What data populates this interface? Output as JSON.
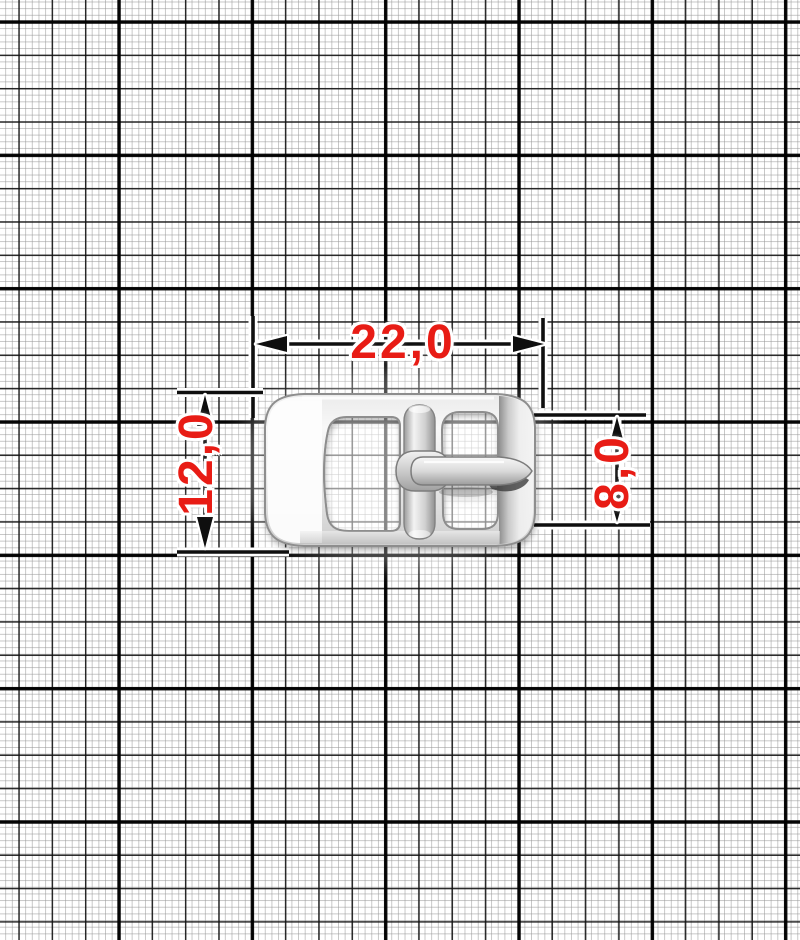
{
  "drawing": {
    "subject": "metal pin buckle on millimeter graph paper",
    "labels": {
      "width": "22,0",
      "height_left": "12,0",
      "height_right": "8,0"
    }
  },
  "colors": {
    "dimension_text_red": "#e81c15",
    "dimension_line_black": "#0f0f0f",
    "grid_bold_line": "#000000",
    "grid_medium_line": "#101010",
    "grid_thin_line": "#969696",
    "paper": "#ffffff",
    "buckle_metal_highlight": "#fdfdfd",
    "buckle_metal_mid": "#d8d8d8",
    "buckle_metal_shadow": "#8a8a8a"
  }
}
